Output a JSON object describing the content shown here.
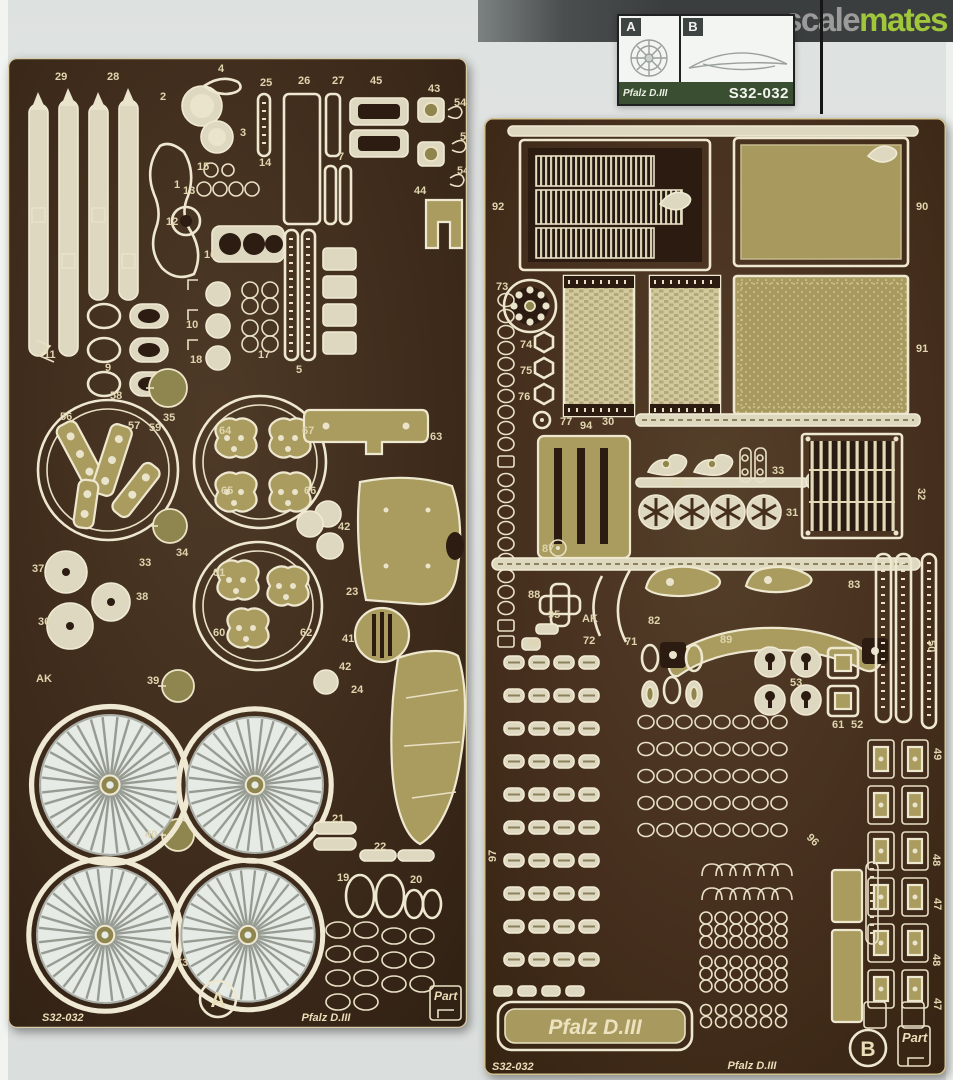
{
  "watermark": {
    "part1": "scale",
    "part2": "mates"
  },
  "product_card": {
    "cell_a": "A",
    "cell_b": "B",
    "name": "Pfalz D.III",
    "sku": "S32-032"
  },
  "colors": {
    "logo_gray": "#9b9b9b",
    "logo_green": "#a0c63c",
    "fret_brown": "#3e2b1c",
    "brass": "#a99c5e",
    "etch_cream": "#efe8d0",
    "card_band_green": "#3a4f31"
  },
  "fret_a": {
    "sku": "S32-032",
    "letter": "A",
    "name": "Pfalz D.III",
    "brand": "Part",
    "labels": [
      {
        "t": "29",
        "x": 47,
        "y": 22
      },
      {
        "t": "28",
        "x": 99,
        "y": 22
      },
      {
        "t": "4",
        "x": 210,
        "y": 14
      },
      {
        "t": "2",
        "x": 152,
        "y": 42
      },
      {
        "t": "3",
        "x": 232,
        "y": 78
      },
      {
        "t": "25",
        "x": 252,
        "y": 28
      },
      {
        "t": "26",
        "x": 290,
        "y": 26
      },
      {
        "t": "27",
        "x": 324,
        "y": 26
      },
      {
        "t": "45",
        "x": 362,
        "y": 26
      },
      {
        "t": "43",
        "x": 420,
        "y": 34
      },
      {
        "t": "54",
        "x": 446,
        "y": 48
      },
      {
        "t": "55",
        "x": 452,
        "y": 82
      },
      {
        "t": "54",
        "x": 449,
        "y": 116
      },
      {
        "t": "15",
        "x": 189,
        "y": 112
      },
      {
        "t": "14",
        "x": 251,
        "y": 108
      },
      {
        "t": "1",
        "x": 166,
        "y": 130
      },
      {
        "t": "13",
        "x": 175,
        "y": 136
      },
      {
        "t": "12",
        "x": 158,
        "y": 167
      },
      {
        "t": "16",
        "x": 196,
        "y": 200
      },
      {
        "t": "10",
        "x": 178,
        "y": 270
      },
      {
        "t": "18",
        "x": 182,
        "y": 305
      },
      {
        "t": "17",
        "x": 250,
        "y": 300
      },
      {
        "t": "7",
        "x": 330,
        "y": 102
      },
      {
        "t": "5",
        "x": 288,
        "y": 315
      },
      {
        "t": "9",
        "x": 97,
        "y": 313
      },
      {
        "t": "11",
        "x": 36,
        "y": 300
      },
      {
        "t": "44",
        "x": 406,
        "y": 136
      },
      {
        "t": "56",
        "x": 52,
        "y": 362
      },
      {
        "t": "58",
        "x": 102,
        "y": 341
      },
      {
        "t": "57",
        "x": 120,
        "y": 371
      },
      {
        "t": "59",
        "x": 141,
        "y": 373
      },
      {
        "t": "35",
        "x": 155,
        "y": 363
      },
      {
        "t": "34",
        "x": 168,
        "y": 498
      },
      {
        "t": "64",
        "x": 211,
        "y": 376
      },
      {
        "t": "67",
        "x": 294,
        "y": 376
      },
      {
        "t": "65",
        "x": 213,
        "y": 436
      },
      {
        "t": "66",
        "x": 296,
        "y": 436
      },
      {
        "t": "33",
        "x": 131,
        "y": 508
      },
      {
        "t": "37",
        "x": 24,
        "y": 514
      },
      {
        "t": "36",
        "x": 30,
        "y": 567
      },
      {
        "t": "38",
        "x": 128,
        "y": 542
      },
      {
        "t": "61",
        "x": 205,
        "y": 518
      },
      {
        "t": "60",
        "x": 205,
        "y": 578
      },
      {
        "t": "62",
        "x": 292,
        "y": 578
      },
      {
        "t": "39",
        "x": 139,
        "y": 626
      },
      {
        "t": "AK",
        "x": 28,
        "y": 624,
        "s": 9
      },
      {
        "t": "40",
        "x": 137,
        "y": 780
      },
      {
        "t": "63",
        "x": 422,
        "y": 382
      },
      {
        "t": "42",
        "x": 330,
        "y": 472
      },
      {
        "t": "23",
        "x": 338,
        "y": 537
      },
      {
        "t": "41",
        "x": 334,
        "y": 584
      },
      {
        "t": "42",
        "x": 331,
        "y": 612
      },
      {
        "t": "24",
        "x": 343,
        "y": 635
      },
      {
        "t": "21",
        "x": 324,
        "y": 764
      },
      {
        "t": "22",
        "x": 366,
        "y": 792
      },
      {
        "t": "19",
        "x": 329,
        "y": 823
      },
      {
        "t": "20",
        "x": 402,
        "y": 825
      },
      {
        "t": "73",
        "x": 168,
        "y": 908
      },
      {
        "t": "S32-032",
        "x": 34,
        "y": 963,
        "s": 23,
        "i": 1,
        "c": "etch"
      },
      {
        "t": "Pfalz D.III",
        "x": 318,
        "y": 963,
        "s": 25,
        "i": 1,
        "a": "middle",
        "c": "etch"
      }
    ]
  },
  "fret_b": {
    "sku": "S32-032",
    "letter": "B",
    "name": "Pfalz D.III",
    "brand": "Part",
    "nameplate": "Pfalz D.III",
    "labels": [
      {
        "t": "92",
        "x": 8,
        "y": 92
      },
      {
        "t": "90",
        "x": 432,
        "y": 92
      },
      {
        "t": "73",
        "x": 12,
        "y": 172
      },
      {
        "t": "74",
        "x": 36,
        "y": 230
      },
      {
        "t": "75",
        "x": 36,
        "y": 256
      },
      {
        "t": "76",
        "x": 34,
        "y": 282
      },
      {
        "t": "77",
        "x": 76,
        "y": 307
      },
      {
        "t": "94",
        "x": 96,
        "y": 311
      },
      {
        "t": "30",
        "x": 118,
        "y": 307
      },
      {
        "t": "91",
        "x": 432,
        "y": 234
      },
      {
        "t": "62",
        "x": 188,
        "y": 368
      },
      {
        "t": "33",
        "x": 288,
        "y": 356
      },
      {
        "t": "32",
        "x": 434,
        "y": 370,
        "r": 90
      },
      {
        "t": "31",
        "x": 302,
        "y": 398
      },
      {
        "t": "87",
        "x": 58,
        "y": 434
      },
      {
        "t": "88",
        "x": 44,
        "y": 480
      },
      {
        "t": "95",
        "x": 64,
        "y": 500
      },
      {
        "t": "98",
        "x": 44,
        "y": 528
      },
      {
        "t": "AK",
        "x": 98,
        "y": 504,
        "s": 9
      },
      {
        "t": "72",
        "x": 99,
        "y": 526
      },
      {
        "t": "71",
        "x": 141,
        "y": 527
      },
      {
        "t": "82",
        "x": 164,
        "y": 506
      },
      {
        "t": "83",
        "x": 364,
        "y": 470
      },
      {
        "t": "89",
        "x": 236,
        "y": 525
      },
      {
        "t": "50",
        "x": 444,
        "y": 522,
        "r": 90
      },
      {
        "t": "53",
        "x": 306,
        "y": 568
      },
      {
        "t": "61",
        "x": 348,
        "y": 610
      },
      {
        "t": "52",
        "x": 367,
        "y": 610
      },
      {
        "t": "97",
        "x": 12,
        "y": 744,
        "r": -90
      },
      {
        "t": "96",
        "x": 322,
        "y": 720,
        "r": 45
      },
      {
        "t": "49",
        "x": 450,
        "y": 630,
        "r": 90
      },
      {
        "t": "48",
        "x": 449,
        "y": 736,
        "r": 90
      },
      {
        "t": "47",
        "x": 450,
        "y": 780,
        "r": 90
      },
      {
        "t": "48",
        "x": 449,
        "y": 836,
        "r": 90
      },
      {
        "t": "47",
        "x": 450,
        "y": 880,
        "r": 90
      },
      {
        "t": "S32-032",
        "x": 8,
        "y": 952,
        "s": 22,
        "i": 1,
        "c": "etch"
      },
      {
        "t": "Pfalz D.III",
        "x": 268,
        "y": 951,
        "s": 23,
        "i": 1,
        "a": "middle",
        "c": "etch"
      }
    ]
  }
}
